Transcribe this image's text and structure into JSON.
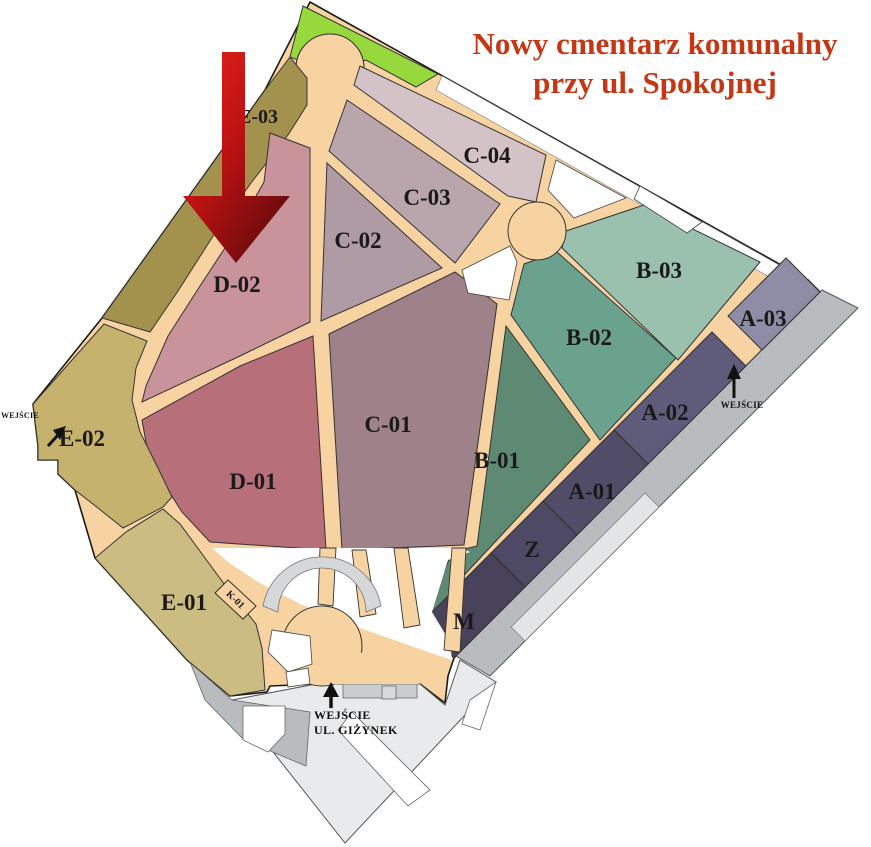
{
  "title": {
    "line1": "Nowy cmentarz komunalny",
    "line2": "przy ul. Spokojnej",
    "color": "#c43714"
  },
  "sections": [
    {
      "id": "E-03",
      "label": "E-03",
      "color": "#a3924e"
    },
    {
      "id": "C-04",
      "label": "C-04",
      "color": "#d3c3c7"
    },
    {
      "id": "C-03",
      "label": "C-03",
      "color": "#b9a6ac"
    },
    {
      "id": "C-02",
      "label": "C-02",
      "color": "#ae9ba4"
    },
    {
      "id": "D-02",
      "label": "D-02",
      "color": "#c8939b"
    },
    {
      "id": "B-03",
      "label": "B-03",
      "color": "#9ac0ae"
    },
    {
      "id": "A-03",
      "label": "A-03",
      "color": "#8f8da5"
    },
    {
      "id": "B-02",
      "label": "B-02",
      "color": "#6aa28d"
    },
    {
      "id": "A-02",
      "label": "A-02",
      "color": "#5e5c7a"
    },
    {
      "id": "C-01",
      "label": "C-01",
      "color": "#9f8289"
    },
    {
      "id": "B-01",
      "label": "B-01",
      "color": "#5e8973"
    },
    {
      "id": "A-01",
      "label": "A-01",
      "color": "#514d69"
    },
    {
      "id": "D-01",
      "label": "D-01",
      "color": "#b76f79"
    },
    {
      "id": "E-02",
      "label": "E-02",
      "color": "#c5b26c"
    },
    {
      "id": "Z",
      "label": "Z",
      "color": "#4e4a66"
    },
    {
      "id": "M",
      "label": "M",
      "color": "#48435b"
    },
    {
      "id": "E-01",
      "label": "E-01",
      "color": "#cbbc82"
    },
    {
      "id": "K-01",
      "label": "K-01",
      "color": "#f8d3a2"
    }
  ],
  "entrances": {
    "left": "WEJŚCIE",
    "right": "WEJŚCIE",
    "bottom_line1": "WEJŚCIE",
    "bottom_line2": "UL. GIŻYNEK"
  },
  "colors": {
    "path": "#f8d3a2",
    "outline": "#2b2b2b",
    "green": "#97d93c",
    "white_area": "#ffffff",
    "road": "#b9bcbe",
    "road_dark": "#a9acaf",
    "parking": "#e9eaeb",
    "gate": "#caccce",
    "arc": "#d6d7d9",
    "walkway": "#e3e4e6",
    "arrow_light": "#e8241d",
    "arrow_mid": "#c01313",
    "arrow_dark": "#5c090b"
  }
}
